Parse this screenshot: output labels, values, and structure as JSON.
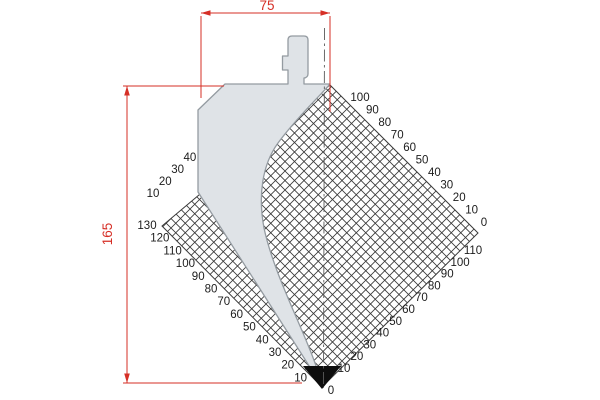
{
  "drawing": {
    "width_dimension": "75",
    "height_dimension": "165",
    "scales": {
      "upper_left": [
        "10",
        "20",
        "30",
        "40"
      ],
      "lower_left": [
        "130",
        "120",
        "110",
        "100",
        "90",
        "80",
        "70",
        "60",
        "50",
        "40",
        "30",
        "20",
        "10"
      ],
      "upper_right": [
        "100",
        "90",
        "80",
        "70",
        "60",
        "50",
        "40",
        "30",
        "20",
        "10",
        "0"
      ],
      "lower_right": [
        "110",
        "100",
        "90",
        "80",
        "70",
        "60",
        "50",
        "40",
        "30",
        "20",
        "10"
      ],
      "tip_zero": "0"
    },
    "colors": {
      "dimension_red": "#d62f26",
      "tool_fill": "#dfe3e7",
      "tool_outline": "#949ba1",
      "hatch_line": "#3a3a3a",
      "tip_black": "#0d0d0d"
    }
  }
}
